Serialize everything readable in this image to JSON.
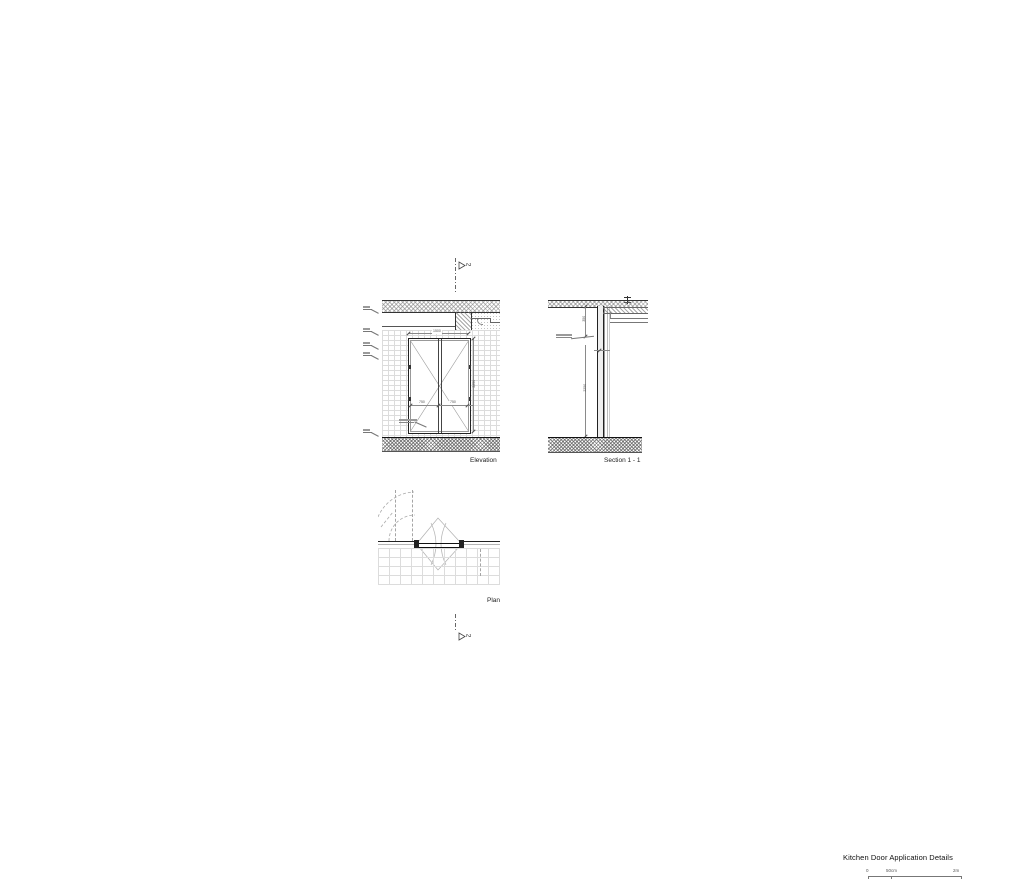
{
  "title_block": {
    "title": "Kitchen Door Application Details"
  },
  "scale_bar": {
    "zero": "0",
    "mid": "50cm",
    "end": "2m"
  },
  "section_marker": {
    "number": "2"
  },
  "elevation": {
    "label": "Elevation",
    "dims": {
      "width_total": "1500",
      "leaf_left": "750",
      "leaf_right": "750",
      "height": "2250"
    }
  },
  "section": {
    "label": "Section 1 - 1",
    "dims": {
      "head": "350",
      "height": "2250"
    }
  },
  "plan": {
    "label": "Plan"
  }
}
